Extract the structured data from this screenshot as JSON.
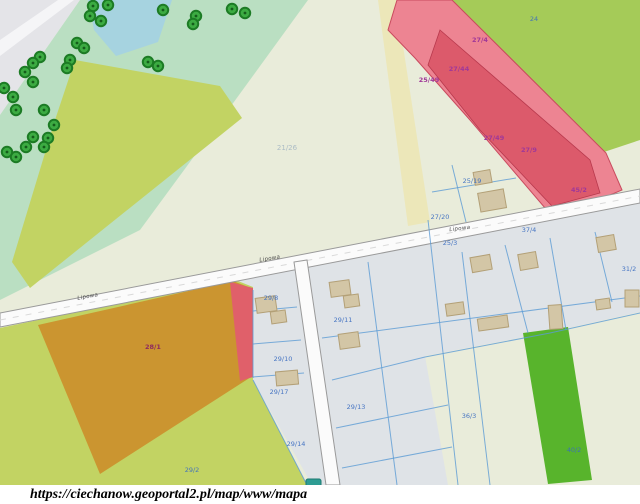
{
  "url_bar": {
    "text": "https://ciechanow.geoportal2.pl/map/www/mapa"
  },
  "map": {
    "street_labels": [
      "Lipowa",
      "Lipowa",
      "Lipowa"
    ],
    "parcels_blue": [
      "21/26",
      "24",
      "25/19",
      "27/20",
      "37/4",
      "25/3",
      "29/8",
      "29/11",
      "29/10",
      "29/17",
      "29/13",
      "29/14",
      "29/2",
      "36/3",
      "40/2",
      "31/2"
    ],
    "parcels_magenta": [
      "27/4",
      "27/44",
      "25/49",
      "27/49",
      "27/9",
      "45/2",
      "28/1"
    ],
    "symbols": {
      "tree": "tree-icon",
      "building": "building-footprint",
      "marker": "teal-marker"
    },
    "colors": {
      "cream": "#e9ecda",
      "gray_corner": "#e4e4e8",
      "gray_road": "#f5f5f7",
      "light_green": "#badfc2",
      "water": "#a6d3e0",
      "chartreuse": "#c2d363",
      "green_top_right": "#a5cb58",
      "parcel_tint": "#dfe3e7",
      "pale_yellow": "#ece7b9",
      "orange": "#cb9530",
      "pink_sliver": "#e0606a",
      "red_outer": "#ed8492",
      "red_inner": "#dc5a6b",
      "red_stroke": "#c94a5e",
      "green_strip": "#58b42c",
      "road_fill": "#fbfbfb",
      "road_stroke": "#9a9a9a",
      "boundary_blue": "#5b9bd5",
      "building_fill": "#d3c6a6",
      "tree_green": "#3cab42",
      "label_blue": "#3a6cc0",
      "label_magenta": "#a03898",
      "marker_teal": "#2e9c93"
    }
  }
}
